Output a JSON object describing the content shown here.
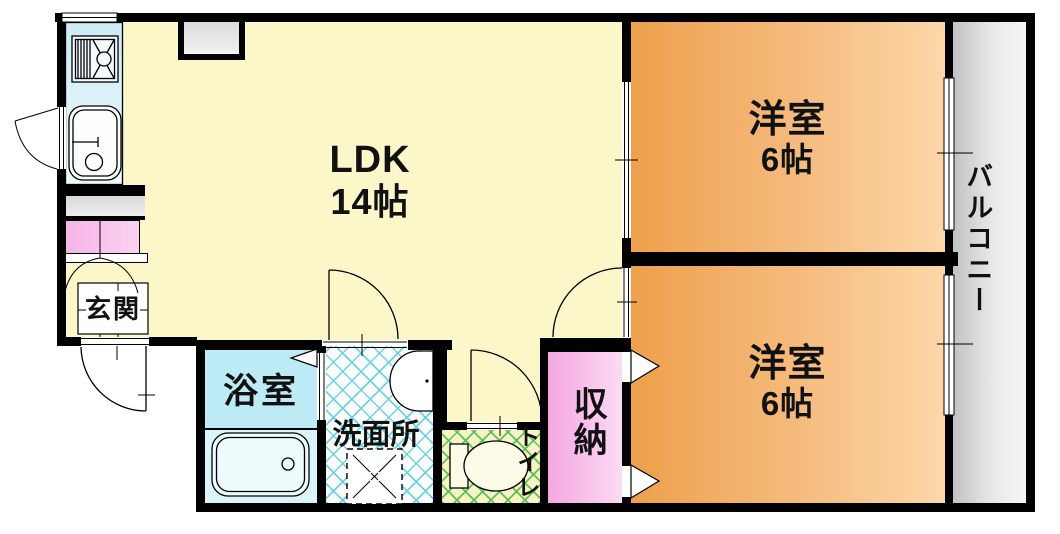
{
  "rooms": {
    "ldk": {
      "name": "LDK",
      "size": "14帖"
    },
    "bedroom_top": {
      "name": "洋室",
      "size": "6帖"
    },
    "bedroom_bottom": {
      "name": "洋室",
      "size": "6帖"
    },
    "balcony": {
      "name": "バルコニー"
    },
    "entrance": {
      "name": "玄関"
    },
    "bathroom": {
      "name": "浴室"
    },
    "washroom": {
      "name": "洗面所"
    },
    "toilet": {
      "name": "トイレ"
    },
    "closet": {
      "name": "収納"
    }
  },
  "colors": {
    "wall": "#000000",
    "ldk_floor": "#fbf7c9",
    "bedroom_dark": "#eea04c",
    "bedroom_light": "#fcd7a8",
    "balcony_gray": "#d9d9d9",
    "bathroom_cyan": "#bdebf5",
    "washroom_lattice": "#66d0e0",
    "toilet_lattice": "#58be50",
    "closet_pink": "#f3a7e0",
    "shoe_cabinet_pink": "#f5b3e7"
  }
}
